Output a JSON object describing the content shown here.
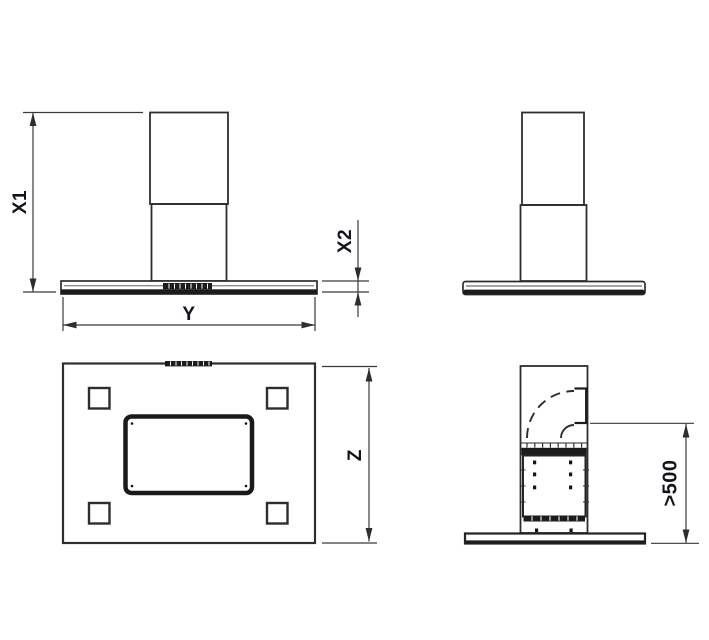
{
  "dimensions": {
    "x1": {
      "label": "X1"
    },
    "x2": {
      "label": "X2"
    },
    "y": {
      "label": "Y"
    },
    "z": {
      "label": "Z"
    },
    "min_clearance": {
      "label": ">500"
    }
  },
  "colors": {
    "background": "#ffffff",
    "outline": "#2e2e2e",
    "dark_fill": "#1c1c1c",
    "dimension_line": "#3a3a3a",
    "label_text": "#12141c"
  }
}
